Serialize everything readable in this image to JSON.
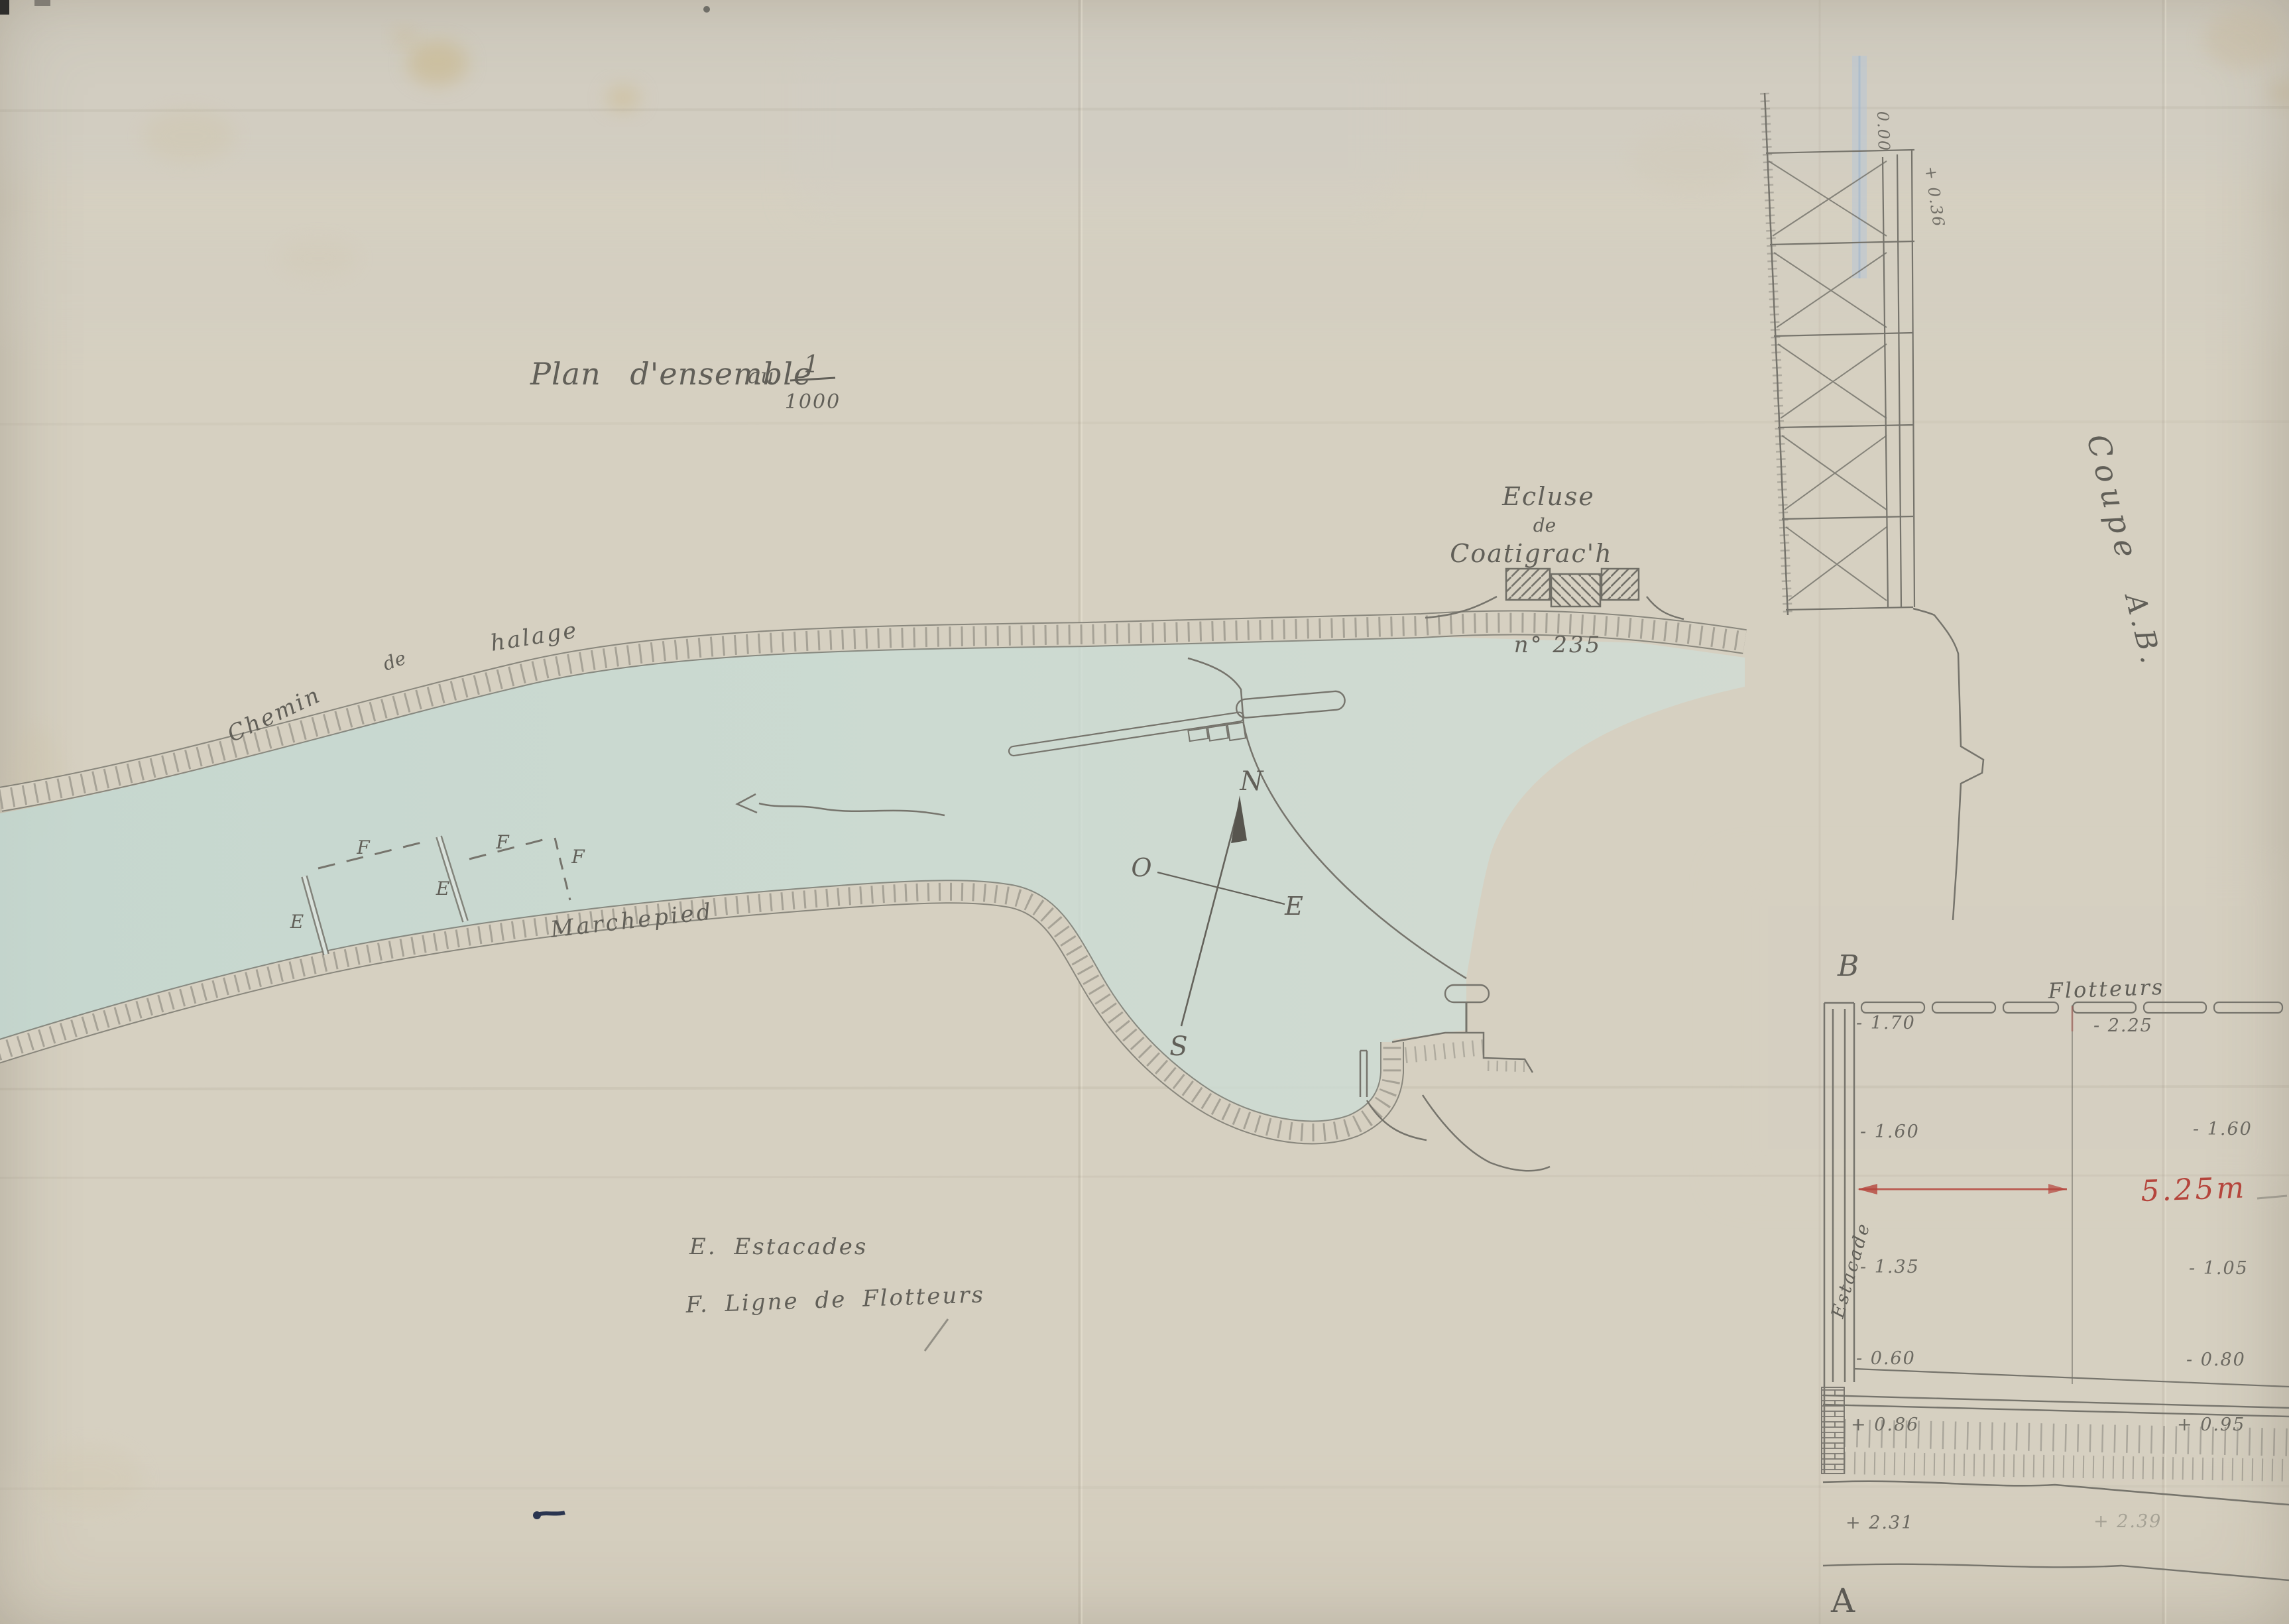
{
  "page": {
    "background": "#d6d0c1",
    "water_color": "#c6dad3",
    "pencil_color": "#76746c",
    "red_color": "#b5453c",
    "blue_color": "#a9bdd2",
    "ink_color": "#2a3550"
  },
  "title": {
    "text": "Plan d'ensemble",
    "au": "au",
    "fraction_numerator": "1",
    "fraction_denominator": "1000"
  },
  "plan": {
    "towpath_word1": "Chemin",
    "towpath_word2": "de",
    "towpath_word3": "halage",
    "footpath": "Marchepied",
    "lock_line1": "Ecluse",
    "lock_line2": "de",
    "lock_line3": "Coatigrac'h",
    "lock_number": "n° 235",
    "compass_n": "N",
    "compass_o": "O",
    "compass_e": "E",
    "compass_s": "S",
    "marker_e1": "E",
    "marker_e2": "E",
    "marker_f1": "F",
    "marker_f2": "F",
    "marker_f3": "F",
    "legend_estacades": "E. Estacades",
    "legend_flotteurs": "F. Ligne de Flotteurs"
  },
  "section": {
    "coupe": "Coupe",
    "coupe_ref": "A.B.",
    "point_b": "B",
    "point_a": "A",
    "flotteurs": "Flotteurs",
    "estacade": "Estacade",
    "dim": "5.25m",
    "level_zero": "0.00",
    "level_top": "+ 0.36",
    "left_levels": [
      "- 1.70",
      "- 1.60",
      "- 1.35",
      "- 0.60",
      "+ 0.86",
      "+ 2.31"
    ],
    "right_levels": [
      "- 2.25",
      "- 1.60",
      "- 1.05",
      "- 0.80",
      "+ 0.95",
      "+ 2.39"
    ]
  }
}
